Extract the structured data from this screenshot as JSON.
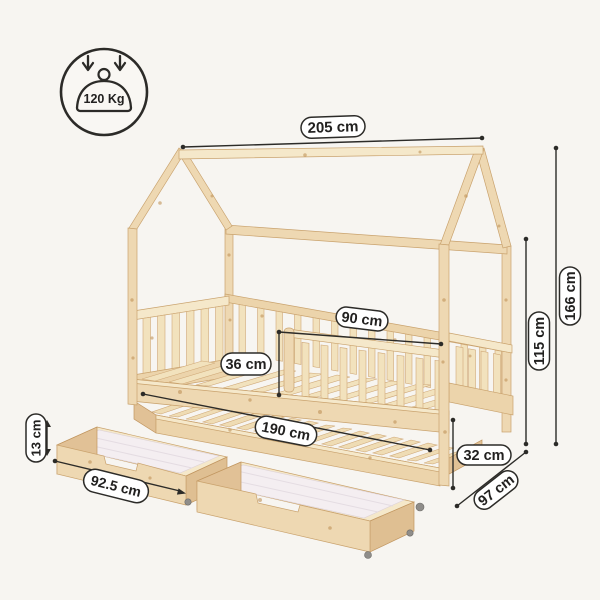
{
  "badge": {
    "max_load": "120 Kg"
  },
  "dimensions": {
    "ridge_length": "205 cm",
    "total_height": "166 cm",
    "frame_height": "115 cm",
    "guard_rail_length": "90 cm",
    "guard_rail_height": "36 cm",
    "drawer_height": "13 cm",
    "drawer_width": "92.5 cm",
    "bed_length": "190 cm",
    "underbed_clearance": "32 cm",
    "bed_depth": "97 cm"
  },
  "colors": {
    "background": "#f7f5f1",
    "accent": "#2c2b28",
    "pill_fill": "#ffffff",
    "wood": "#eed8b2",
    "drawer_interior": "#f4eef1"
  }
}
